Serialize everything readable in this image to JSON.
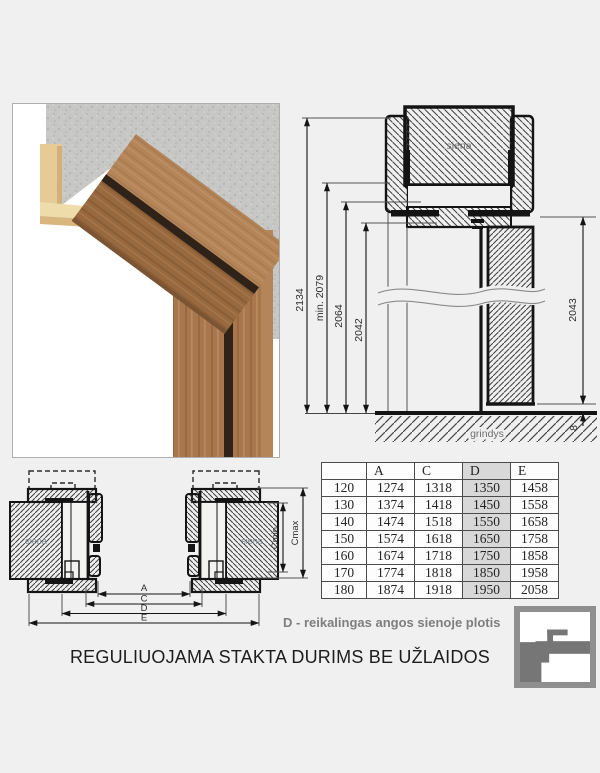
{
  "title": "REGULIUOJAMA STAKTA DURIMS BE UŽLAIDOS",
  "note_d": "D - reikalingas angos sienoje plotis",
  "section_drawing": {
    "wall_label": "siena",
    "floor_label": "grindys",
    "dims": {
      "total": "2134",
      "min": "min. 2079",
      "mid": "2064",
      "opening": "2042",
      "door": "2043",
      "gap": "8"
    }
  },
  "plan_drawing": {
    "wall_label_left": "siena",
    "wall_label_right": "siena",
    "dims": {
      "a": "A",
      "c": "C",
      "d": "D",
      "e": "E",
      "cmin": "Cmin",
      "cmax": "Cmax"
    }
  },
  "table": {
    "headers": [
      "",
      "A",
      "C",
      "D",
      "E"
    ],
    "highlight_column": "D",
    "rows": [
      [
        "120",
        "1274",
        "1318",
        "1350",
        "1458"
      ],
      [
        "130",
        "1374",
        "1418",
        "1450",
        "1558"
      ],
      [
        "140",
        "1474",
        "1518",
        "1550",
        "1658"
      ],
      [
        "150",
        "1574",
        "1618",
        "1650",
        "1758"
      ],
      [
        "160",
        "1674",
        "1718",
        "1750",
        "1858"
      ],
      [
        "170",
        "1774",
        "1818",
        "1850",
        "1958"
      ],
      [
        "180",
        "1874",
        "1918",
        "1950",
        "2058"
      ]
    ]
  },
  "logo": {
    "name": "frame-profile-logo"
  },
  "colors": {
    "background": "#f0f0f0",
    "line": "#141414",
    "table_highlight": "#d8d8d8",
    "note_gray": "#7e7e7e",
    "logo_gray": "#8f8f8f",
    "wood": "#9a6b44",
    "mdf_cream": "#e6cb97",
    "concrete": "#c8c8c6"
  }
}
